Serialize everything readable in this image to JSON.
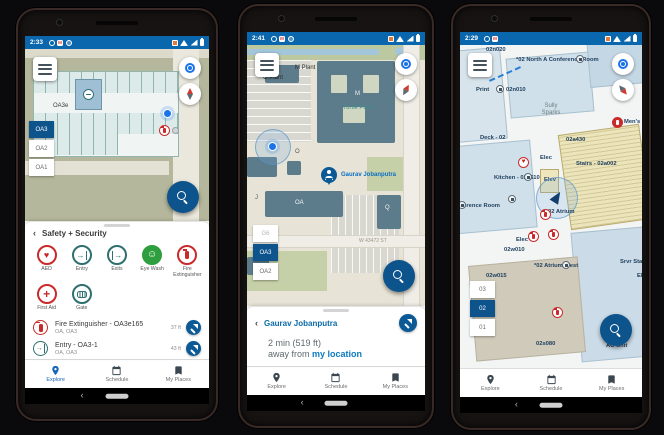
{
  "colors": {
    "statusbar": "#0a66ad",
    "accent_blue": "#0d538c",
    "link_blue": "#0a6aa8",
    "marker_red": "#c92a2a",
    "safety_teal": "#2f6f6f",
    "eyewash_green": "#2e9e3f",
    "building_slate": "#5d7c8b",
    "map_olive": "#b4b79b"
  },
  "glyphs": {
    "back": "‹",
    "heart": "♥",
    "face": "☺",
    "plus": "+",
    "door_arrow": "→"
  },
  "nav": {
    "explore": "Explore",
    "schedule": "Schedule",
    "my_places": "My Places"
  },
  "phones": [
    {
      "status": {
        "time": "2:33"
      },
      "map": {
        "room_label": "OA3e",
        "floors": [
          {
            "label": "OA3"
          },
          {
            "label": "OA2"
          },
          {
            "label": "OA1"
          }
        ]
      },
      "sheet": {
        "title": "Safety + Security",
        "categories": [
          {
            "label": "AED"
          },
          {
            "label": "Entry"
          },
          {
            "label": "Exits"
          },
          {
            "label": "Eye Wash"
          },
          {
            "label": "Fire Extinguisher"
          },
          {
            "label": "First Aid"
          },
          {
            "label": "Gate"
          }
        ],
        "items": [
          {
            "title": "Fire Extinguisher - OA3e165",
            "subtitle": "OA, OA3",
            "distance": "37 ft"
          },
          {
            "title": "Entry - OA3-1",
            "subtitle": "OA, OA3",
            "distance": "43 ft"
          }
        ]
      }
    },
    {
      "status": {
        "time": "2:41"
      },
      "map": {
        "labels": {
          "m_plant": "M Plant",
          "o_plant": "O Plant",
          "m": "M",
          "turtle_pond": "Turtle Pond",
          "o": "O",
          "oa": "OA",
          "j": "J",
          "q": "Q",
          "street": "W 43472 ST"
        },
        "person": "Gaurav Jobanputra",
        "floors": [
          {
            "label": "G6"
          },
          {
            "label": "OA3"
          },
          {
            "label": "OA2"
          }
        ]
      },
      "sheet": {
        "title": "Gaurav Jobanputra",
        "eta": "2 min (519 ft)",
        "away_prefix": "away from",
        "away_link": "my location"
      }
    },
    {
      "status": {
        "time": "2:29"
      },
      "map": {
        "labels": {
          "n020": "02n020",
          "north_conf": "*02 North A Conference Room",
          "print": "Print",
          "n010": "02n010",
          "person1": "Sully Sparks",
          "mens": "Men's - 02a330",
          "deck": "Deck - 02",
          "a430": "02a430",
          "elec1": "Elec",
          "kitchen": "Kitchen - 02a510",
          "elev": "Elev",
          "stairs": "Stairs - 02a002",
          "conf": "Conference Room",
          "atrium": "02 Atrium",
          "w010": "02w010",
          "atrium_west": "*02 Atrium West",
          "w015": "02w015",
          "srvr": "Srvr Staging",
          "elec2": "Elec",
          "elec3": "Elec",
          "s080": "02s080",
          "ac": "AC Unit"
        },
        "floors": [
          {
            "label": "03"
          },
          {
            "label": "02"
          },
          {
            "label": "01"
          }
        ]
      }
    }
  ]
}
